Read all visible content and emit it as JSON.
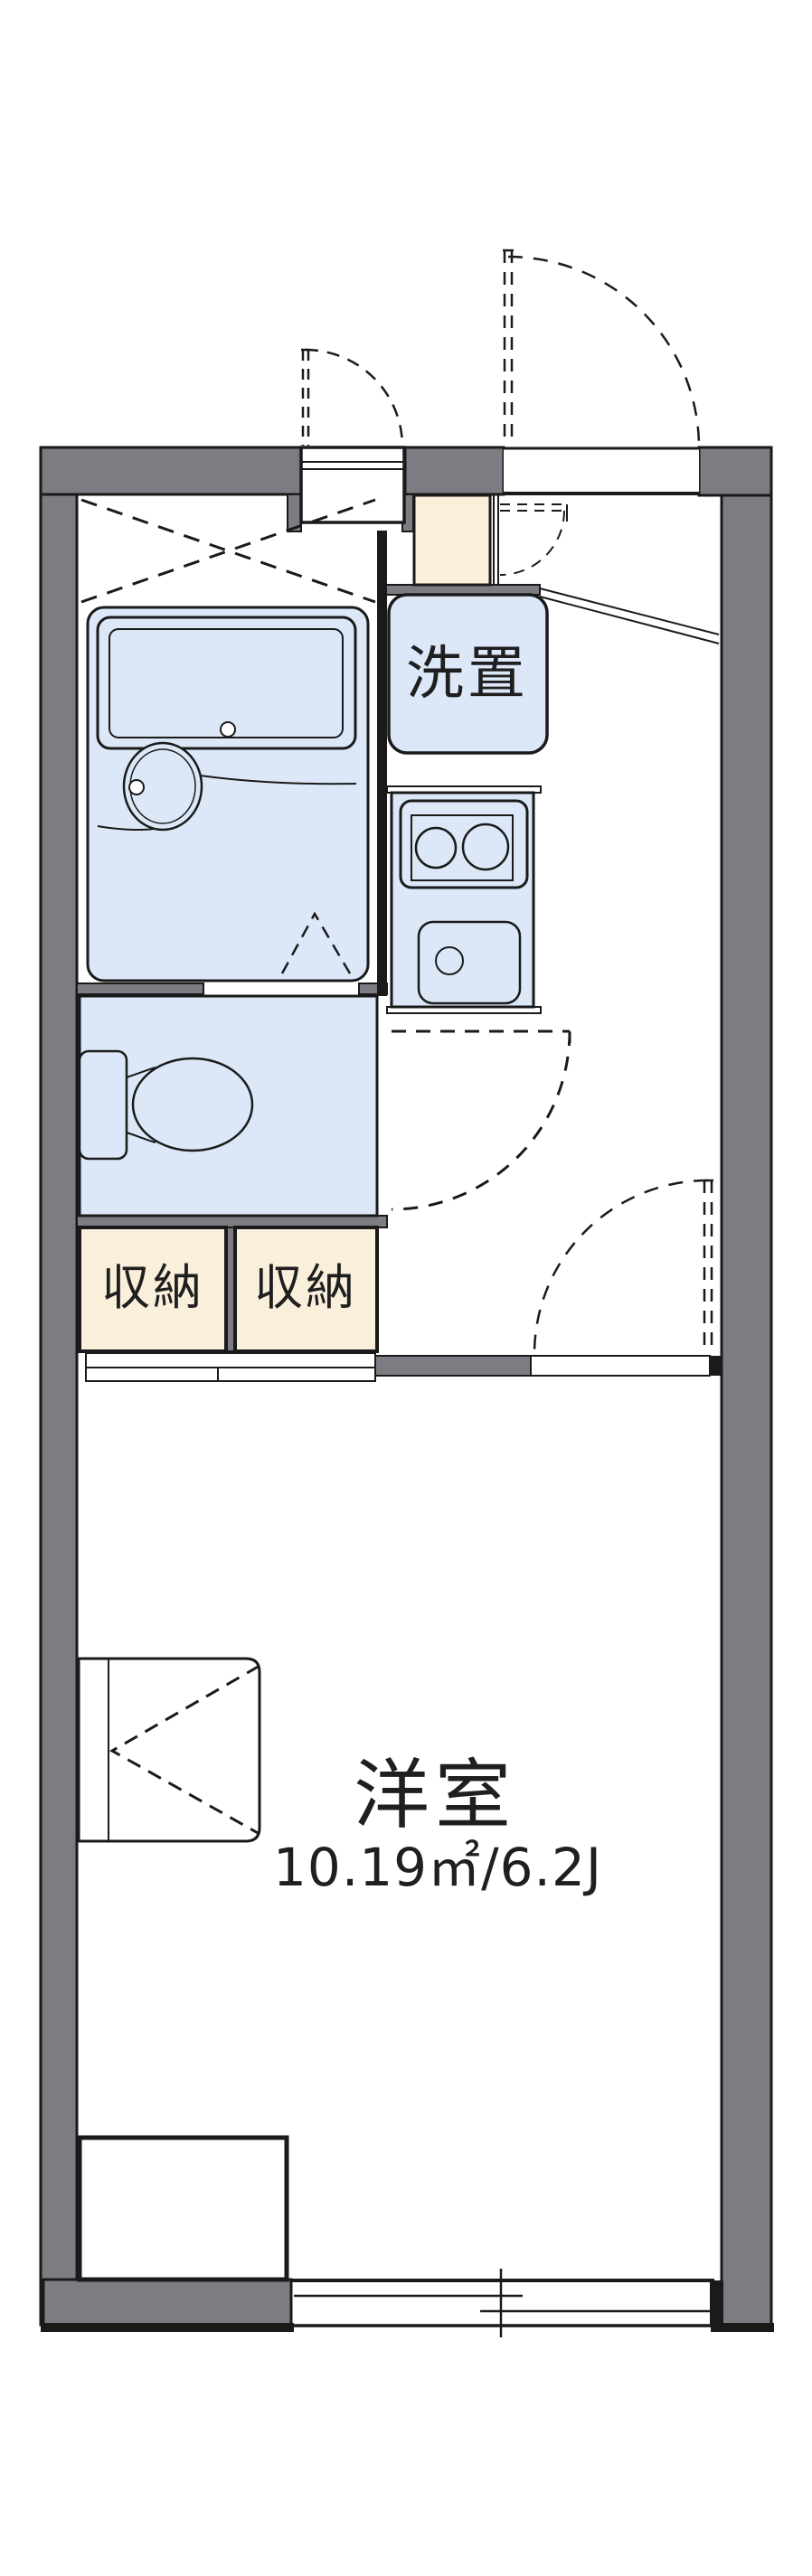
{
  "floorplan": {
    "rooms": {
      "western_room": {
        "label": "洋室",
        "area_label": "10.19㎡/6.2J"
      },
      "laundry_space": {
        "label": "洗置"
      },
      "storage_left": {
        "label": "収納"
      },
      "storage_right": {
        "label": "収納"
      }
    },
    "colors": {
      "wall": "#7c7c82",
      "fixture_blue": "#dce8f7",
      "storage_cream": "#faefdb",
      "line": "#1a1a1a",
      "background": "#ffffff"
    }
  }
}
